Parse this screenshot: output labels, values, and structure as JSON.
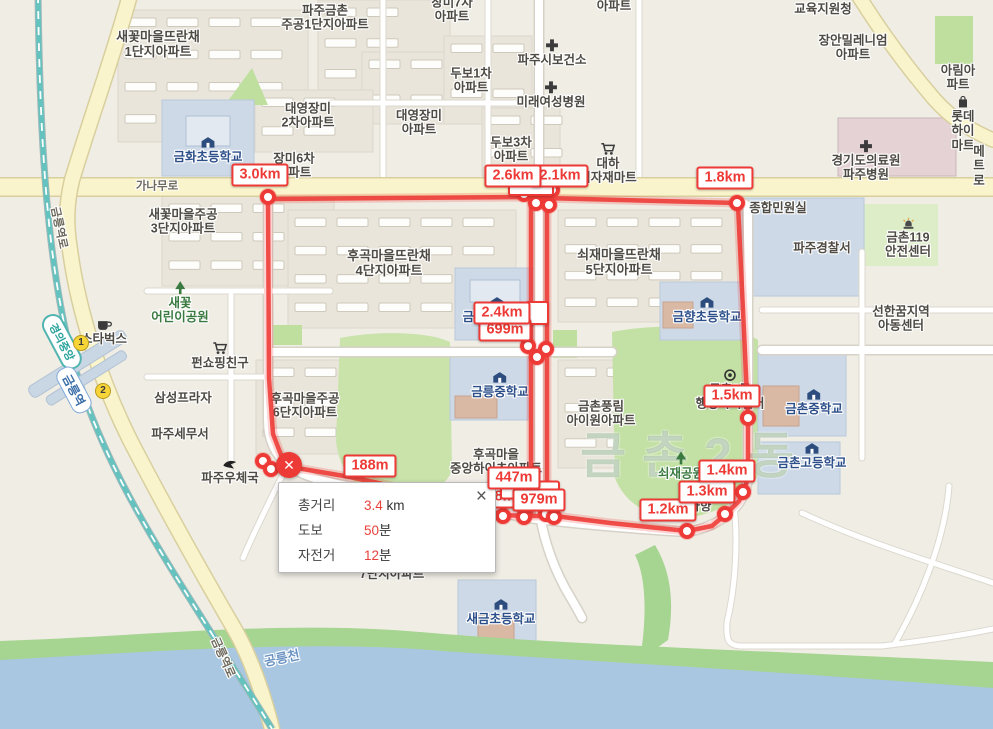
{
  "map": {
    "district_watermark": "금촌2동",
    "station": {
      "line_badge": "경의중앙",
      "line_x": 62,
      "line_y": 342,
      "name": "금릉역",
      "name_x": 74,
      "name_y": 390,
      "exits": [
        {
          "n": "1",
          "x": 81,
          "y": 343
        },
        {
          "n": "2",
          "x": 103,
          "y": 391
        }
      ]
    },
    "places": [
      {
        "id": "saekkot-ttranchae-1danji",
        "text": "새꽃마을뜨란채\n1단지아파트",
        "x": 158,
        "y": 45,
        "cls": "big"
      },
      {
        "id": "paju-geumchon-jugong-1danji",
        "text": "파주금촌\n주공1단지아파트",
        "x": 325,
        "y": 18
      },
      {
        "id": "jangmi-7cha-apt",
        "text": "장미7차\n아파트",
        "x": 452,
        "y": 10
      },
      {
        "id": "apt-partial-top",
        "text": "아파트",
        "x": 614,
        "y": 6
      },
      {
        "id": "dubo-1cha-apt",
        "text": "두보1차\n아파트",
        "x": 471,
        "y": 81
      },
      {
        "id": "paju-health-center",
        "text": "파주시보건소",
        "x": 552,
        "y": 53,
        "icon": "cross"
      },
      {
        "id": "mirae-womens-hospital",
        "text": "미래여성병원",
        "x": 551,
        "y": 95,
        "icon": "cross"
      },
      {
        "id": "daeyoung-jangmi-2cha",
        "text": "대영장미\n2차아파트",
        "x": 308,
        "y": 116
      },
      {
        "id": "daeyoung-jangmi-apt",
        "text": "대영장미\n아파트",
        "x": 419,
        "y": 123
      },
      {
        "id": "dubo-3cha-apt",
        "text": "두보3차\n아파트",
        "x": 511,
        "y": 150
      },
      {
        "id": "daeha-mart",
        "text": "대하\n식자재마트",
        "x": 608,
        "y": 164,
        "icon": "cart"
      },
      {
        "id": "jangmi-6cha-apt",
        "text": "장미6차\n아파트",
        "x": 294,
        "y": 166
      },
      {
        "id": "geumhwa-elementary",
        "text": "금화초등학교",
        "x": 208,
        "y": 150,
        "cls": "school",
        "icon": "school"
      },
      {
        "id": "ganamu-ro",
        "text": "가나무로",
        "x": 157,
        "y": 187,
        "cls": "road"
      },
      {
        "id": "saekkot-jugong-3danji",
        "text": "새꽃마을주공\n3단지아파트",
        "x": 183,
        "y": 222
      },
      {
        "id": "education-office",
        "text": "교육지원청",
        "x": 823,
        "y": 9
      },
      {
        "id": "jangan-millennium-apt",
        "text": "장안밀레니엄\n아파트",
        "x": 853,
        "y": 48
      },
      {
        "id": "arim-apt",
        "text": "아림아파트",
        "x": 958,
        "y": 78
      },
      {
        "id": "lotte-himart",
        "text": "롯데하이마트",
        "x": 963,
        "y": 124,
        "icon": "bag"
      },
      {
        "id": "gyeonggi-medical-center",
        "text": "경기도의료원\n파주병원",
        "x": 866,
        "y": 161,
        "icon": "cross"
      },
      {
        "id": "metro-partial",
        "text": "메트로",
        "x": 979,
        "y": 166
      },
      {
        "id": "minwon-office",
        "text": "종합민원실",
        "x": 778,
        "y": 208
      },
      {
        "id": "paju-police",
        "text": "파주경찰서",
        "x": 822,
        "y": 248
      },
      {
        "id": "geumchon-119",
        "text": "금촌119\n안전센터",
        "x": 908,
        "y": 238,
        "icon": "siren"
      },
      {
        "id": "saekkot-childrens-park",
        "text": "새꽃\n어린이공원",
        "x": 180,
        "y": 303,
        "cls": "park",
        "icon": "tree"
      },
      {
        "id": "starbucks",
        "text": "스타벅스",
        "x": 104,
        "y": 332,
        "icon": "coffee"
      },
      {
        "id": "fun-shopping",
        "text": "펀쇼핑친구",
        "x": 220,
        "y": 356,
        "icon": "cart"
      },
      {
        "id": "samsung-plaza",
        "text": "삼성프라자",
        "x": 183,
        "y": 398
      },
      {
        "id": "paju-tax-office",
        "text": "파주세무서",
        "x": 180,
        "y": 434
      },
      {
        "id": "paju-post-office",
        "text": "파주우체국",
        "x": 230,
        "y": 472,
        "icon": "post"
      },
      {
        "id": "hugok-ttranchae-4danji",
        "text": "후곡마을뜨란채\n4단지아파트",
        "x": 389,
        "y": 264,
        "cls": "big"
      },
      {
        "id": "geumneung-elementary",
        "text": "금릉초등학교",
        "x": 497,
        "y": 310,
        "cls": "school",
        "icon": "school"
      },
      {
        "id": "geumneung-middle",
        "text": "금릉중학교",
        "x": 500,
        "y": 385,
        "cls": "school",
        "icon": "school"
      },
      {
        "id": "hugok-jugong-6danji",
        "text": "후곡마을주공\n6단지아파트",
        "x": 305,
        "y": 406
      },
      {
        "id": "hugok-jungang-heights",
        "text": "후곡마을\n중앙하이츠아파트",
        "x": 496,
        "y": 462
      },
      {
        "id": "soejae-ttranchae-5danji",
        "text": "쇠재마을뜨란채\n5단지아파트",
        "x": 619,
        "y": 263,
        "cls": "big"
      },
      {
        "id": "geumchon-pungnim-apt",
        "text": "금촌풍림\n아이원아파트",
        "x": 601,
        "y": 414
      },
      {
        "id": "geumhyang-elementary",
        "text": "금향초등학교",
        "x": 707,
        "y": 310,
        "cls": "school",
        "icon": "school"
      },
      {
        "id": "seonhankkum-center",
        "text": "선한꿈지역\n아동센터",
        "x": 901,
        "y": 319
      },
      {
        "id": "geumchon-2dong-center",
        "text": "금촌2동\n행정복지센터",
        "x": 730,
        "y": 390,
        "icon": "target"
      },
      {
        "id": "geumchon-middle",
        "text": "금촌중학교",
        "x": 814,
        "y": 402,
        "cls": "school",
        "icon": "school"
      },
      {
        "id": "geumchon-high",
        "text": "금촌고등학교",
        "x": 812,
        "y": 456,
        "cls": "school",
        "icon": "school"
      },
      {
        "id": "soejae-park",
        "text": "쇠재공원",
        "x": 681,
        "y": 466,
        "cls": "park",
        "icon": "tree"
      },
      {
        "id": "hahyang",
        "text": "하향",
        "x": 700,
        "y": 506
      },
      {
        "id": "danji-7-apt",
        "text": "7단지아파트",
        "x": 392,
        "y": 574
      },
      {
        "id": "saegeum-elementary",
        "text": "새금초등학교",
        "x": 501,
        "y": 612,
        "cls": "school",
        "icon": "school"
      },
      {
        "id": "gongneung-stream",
        "text": "공릉천",
        "x": 282,
        "y": 659,
        "cls": "water",
        "rot": -12
      },
      {
        "id": "geumneungyeok-ro-south",
        "text": "금릉역로",
        "x": 222,
        "y": 658,
        "cls": "road",
        "rot": 66
      },
      {
        "id": "geumneungyeok-ro-north",
        "text": "금릉역로",
        "x": 58,
        "y": 228,
        "cls": "road",
        "rot": 78
      }
    ]
  },
  "measurement": {
    "accent_color": "#ee3a36",
    "labels": [
      {
        "text": "3.0km",
        "x": 260,
        "y": 175,
        "z": 2
      },
      {
        "text": "2.6km",
        "x": 513,
        "y": 176,
        "z": 3
      },
      {
        "text": "2.1km",
        "x": 560,
        "y": 176,
        "z": 2
      },
      {
        "text": "",
        "x": 531,
        "y": 189,
        "z": 1,
        "blank": true,
        "w": 42,
        "h": 10
      },
      {
        "text": "1.8km",
        "x": 725,
        "y": 178,
        "z": 2
      },
      {
        "text": "2.4km",
        "x": 502,
        "y": 313,
        "z": 4
      },
      {
        "text": "699m",
        "x": 505,
        "y": 330,
        "z": 3
      },
      {
        "text": "",
        "x": 537,
        "y": 313,
        "z": 2,
        "blank": true,
        "w": 20,
        "h": 20
      },
      {
        "text": "188m",
        "x": 370,
        "y": 466,
        "z": 2
      },
      {
        "text": "447m",
        "x": 514,
        "y": 478,
        "z": 5
      },
      {
        "text": "418m",
        "x": 497,
        "y": 497,
        "z": 2
      },
      {
        "text": "",
        "x": 530,
        "y": 490,
        "z": 3,
        "blank": true,
        "w": 56,
        "h": 15
      },
      {
        "text": "979m",
        "x": 539,
        "y": 500,
        "z": 4
      },
      {
        "text": "1.2km",
        "x": 668,
        "y": 510,
        "z": 2
      },
      {
        "text": "1.3km",
        "x": 707,
        "y": 492,
        "z": 2
      },
      {
        "text": "1.4km",
        "x": 727,
        "y": 471,
        "z": 2
      },
      {
        "text": "1.5km",
        "x": 732,
        "y": 396,
        "z": 2
      }
    ],
    "vertices": [
      [
        268,
        197
      ],
      [
        737,
        203
      ],
      [
        748,
        418
      ],
      [
        524,
        194
      ],
      [
        540,
        192
      ],
      [
        552,
        190
      ],
      [
        536,
        203
      ],
      [
        549,
        205
      ],
      [
        528,
        346
      ],
      [
        546,
        349
      ],
      [
        537,
        357
      ],
      [
        503,
        516
      ],
      [
        524,
        517
      ],
      [
        546,
        514
      ],
      [
        554,
        517
      ],
      [
        687,
        531
      ],
      [
        725,
        514
      ],
      [
        743,
        492
      ],
      [
        263,
        461
      ],
      [
        271,
        469
      ]
    ],
    "end_marker": {
      "x": 289,
      "y": 465,
      "glyph": "✕"
    },
    "routes": [
      [
        [
          268,
          199
        ],
        [
          527,
          197
        ],
        [
          543,
          198
        ],
        [
          737,
          203
        ]
      ],
      [
        [
          268,
          197
        ],
        [
          269,
          378
        ],
        [
          273,
          434
        ],
        [
          281,
          455
        ],
        [
          289,
          465
        ]
      ],
      [
        [
          291,
          467
        ],
        [
          350,
          477
        ],
        [
          420,
          492
        ],
        [
          470,
          504
        ],
        [
          503,
          515
        ]
      ],
      [
        [
          503,
          515
        ],
        [
          527,
          516
        ],
        [
          555,
          516
        ],
        [
          610,
          523
        ],
        [
          687,
          531
        ],
        [
          712,
          526
        ],
        [
          726,
          514
        ],
        [
          739,
          501
        ],
        [
          745,
          489
        ],
        [
          748,
          476
        ],
        [
          748,
          418
        ],
        [
          743,
          310
        ],
        [
          738,
          205
        ]
      ],
      [
        [
          531,
          198
        ],
        [
          531,
          514
        ]
      ],
      [
        [
          547,
          198
        ],
        [
          547,
          514
        ]
      ]
    ]
  },
  "popup": {
    "close": "×",
    "rows": [
      {
        "label": "총거리",
        "value": "3.4",
        "unit": " km"
      },
      {
        "label": "도보",
        "value": "50",
        "unit": "분"
      },
      {
        "label": "자전거",
        "value": "12",
        "unit": "분"
      }
    ]
  }
}
